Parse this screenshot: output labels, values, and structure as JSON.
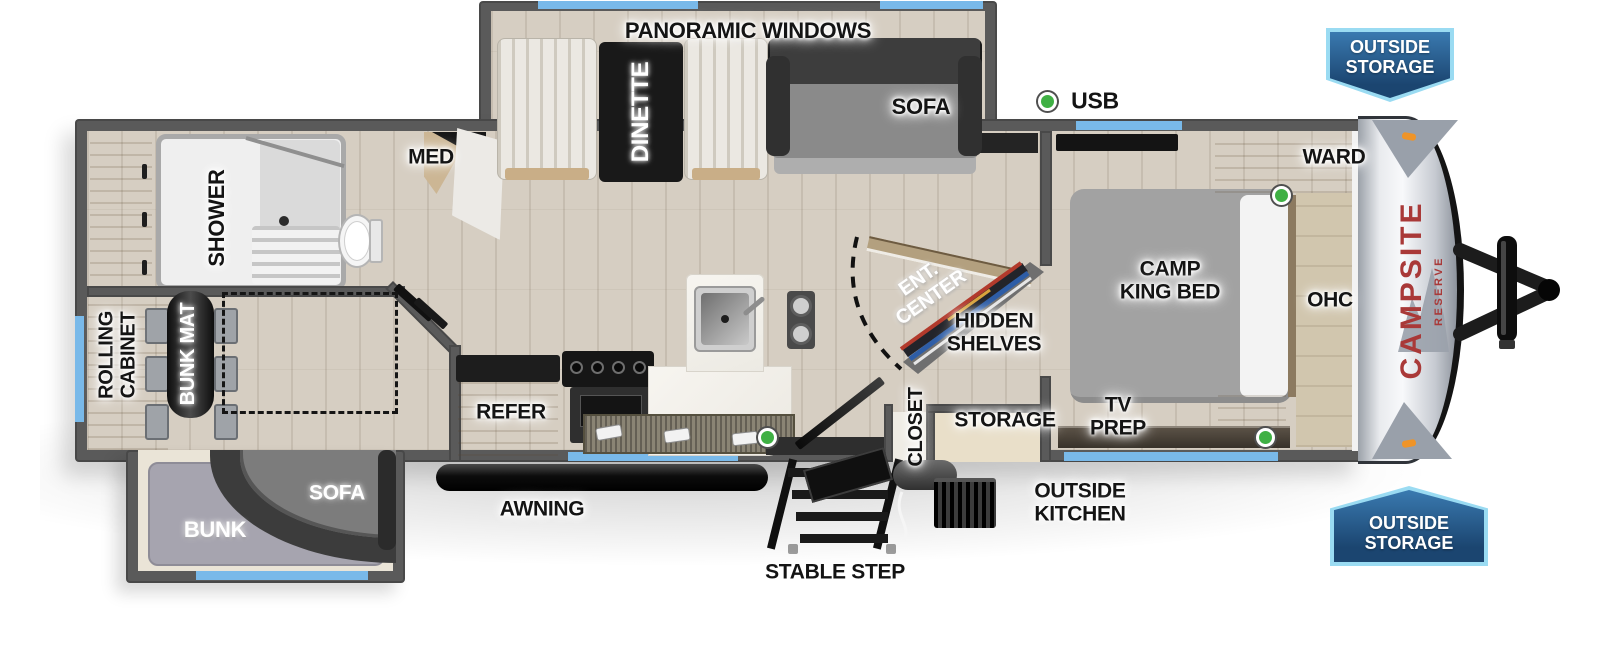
{
  "title": "Campsite Reserve Travel Trailer Floorplan",
  "brand": {
    "model": "CAMPSITE",
    "series": "RESERVE"
  },
  "legend": {
    "usb": "USB"
  },
  "badges": {
    "top": "OUTSIDE\nSTORAGE",
    "bottom": "OUTSIDE\nSTORAGE"
  },
  "labels": {
    "panoramic_windows": "PANORAMIC WINDOWS",
    "dinette": "DINETTE",
    "sofa_main": "SOFA",
    "med": "MED",
    "shower": "SHOWER",
    "ward": "WARD",
    "camp_king_bed": "CAMP\nKING BED",
    "ohc": "OHC",
    "ent_center": "ENT.\nCENTER",
    "hidden_shelves": "HIDDEN\nSHELVES",
    "rolling_cabinet": "ROLLING\nCABINET",
    "bunk_mat": "BUNK MAT",
    "refer": "REFER",
    "closet": "CLOSET",
    "storage": "STORAGE",
    "tv_prep": "TV\nPREP",
    "outside_kitchen": "OUTSIDE\nKITCHEN",
    "awning": "AWNING",
    "sofa_bunk": "SOFA",
    "bunk": "BUNK",
    "stable_step": "STABLE STEP"
  },
  "colors": {
    "wall": "#5a5a5a",
    "floor_wood": "#d6cec2",
    "window_blue": "#79b9e9",
    "usb_green": "#3fb044",
    "badge_blue": "#2f6da6",
    "badge_border": "#9adbf2",
    "logo_red": "#a93938",
    "awning_black": "#111111"
  }
}
